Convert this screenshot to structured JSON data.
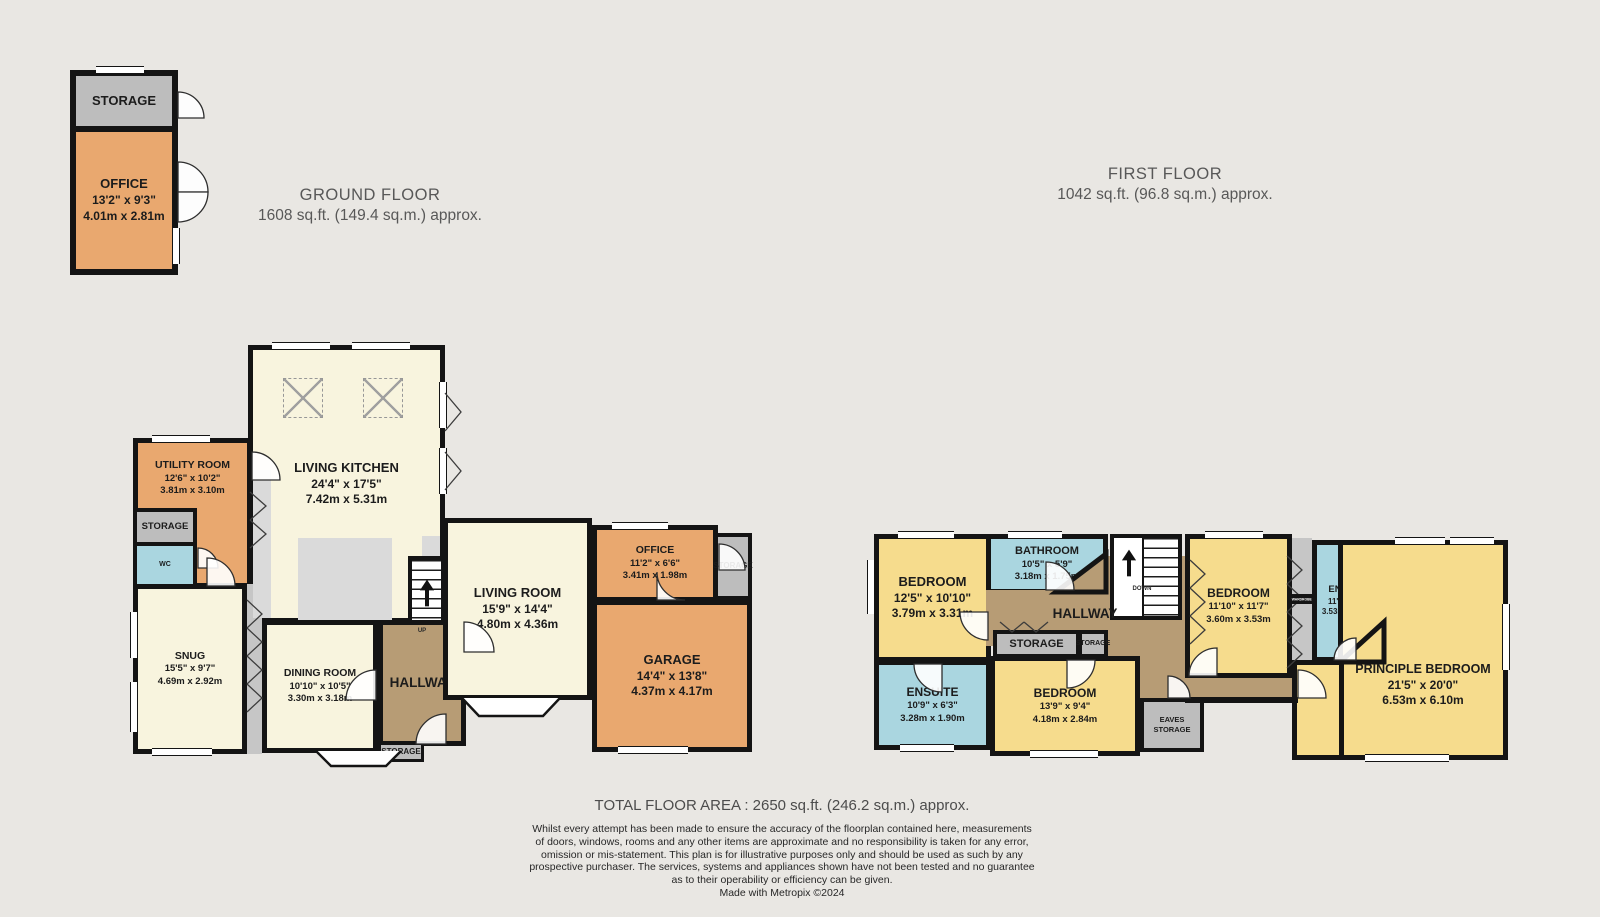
{
  "titles": {
    "ground_floor": {
      "name": "GROUND FLOOR",
      "area": "1608 sq.ft. (149.4 sq.m.) approx."
    },
    "first_floor": {
      "name": "FIRST FLOOR",
      "area": "1042 sq.ft. (96.8 sq.m.) approx."
    }
  },
  "outbuilding": {
    "storage_label": "STORAGE",
    "office": {
      "name": "OFFICE",
      "imperial": "13'2\" x 9'3\"",
      "metric": "4.01m x 2.81m"
    }
  },
  "ground_floor": {
    "living_kitchen": {
      "name": "LIVING KITCHEN",
      "imperial": "24'4\" x 17'5\"",
      "metric": "7.42m x 5.31m"
    },
    "utility_room": {
      "name": "UTILITY ROOM",
      "imperial": "12'6\" x 10'2\"",
      "metric": "3.81m x 3.10m"
    },
    "storage_label": "STORAGE",
    "wc_label": "WC",
    "snug": {
      "name": "SNUG",
      "imperial": "15'5\" x 9'7\"",
      "metric": "4.69m x 2.92m"
    },
    "dining_room": {
      "name": "DINING ROOM",
      "imperial": "10'10\" x 10'5\"",
      "metric": "3.30m x 3.18m"
    },
    "hallway_label": "HALLWAY",
    "hall_storage_label": "STORAGE",
    "up_label": "UP",
    "living_room": {
      "name": "LIVING ROOM",
      "imperial": "15'9\" x 14'4\"",
      "metric": "4.80m x 4.36m"
    },
    "office": {
      "name": "OFFICE",
      "imperial": "11'2\" x 6'6\"",
      "metric": "3.41m x 1.98m"
    },
    "office_storage_label": "STORAGE",
    "garage": {
      "name": "GARAGE",
      "imperial": "14'4\" x 13'8\"",
      "metric": "4.37m x 4.17m"
    }
  },
  "first_floor": {
    "bedroom_1": {
      "name": "BEDROOM",
      "imperial": "12'5\" x 10'10\"",
      "metric": "3.79m x 3.31m"
    },
    "bathroom": {
      "name": "BATHROOM",
      "imperial": "10'5\" x 5'9\"",
      "metric": "3.18m x 1.75m"
    },
    "hallway_label": "HALLWAY",
    "down_label": "DOWN",
    "storage_label": "STORAGE",
    "storage_small_label": "STORAGE",
    "ensuite_1": {
      "name": "ENSUITE",
      "imperial": "10'9\" x 6'3\"",
      "metric": "3.28m x 1.90m"
    },
    "bedroom_2": {
      "name": "BEDROOM",
      "imperial": "13'9\" x 9'4\"",
      "metric": "4.18m x 2.84m"
    },
    "eaves_storage_label": "EAVES STORAGE",
    "bedroom_3": {
      "name": "BEDROOM",
      "imperial": "11'10\" x 11'7\"",
      "metric": "3.60m x 3.53m"
    },
    "wardrobe_label": "WARDROBE",
    "ensuite_2": {
      "name": "ENSUITE",
      "imperial": "11'7\" x 6'9\"",
      "metric": "3.53m x 2.06m"
    },
    "principle_bedroom": {
      "name": "PRINCIPLE BEDROOM",
      "imperial": "21'5\" x 20'0\"",
      "metric": "6.53m x 6.10m"
    }
  },
  "footer": {
    "total_area": "TOTAL FLOOR AREA : 2650 sq.ft. (246.2 sq.m.) approx.",
    "disclaimer_lines": [
      "Whilst every attempt has been made to ensure the accuracy of the floorplan contained here, measurements",
      "of doors, windows, rooms and any other items are approximate and no responsibility is taken for any error,",
      "omission or mis-statement. This plan is for illustrative purposes only and should be used as such by any",
      "prospective purchaser. The services, systems and appliances shown have not been tested and no guarantee",
      "as to their operability or efficiency can be given.",
      "Made with Metropix ©2024"
    ]
  },
  "colors": {
    "background": "#e9e7e3",
    "wall": "#141414",
    "cream_room": "#f8f4de",
    "orange_room": "#e9a86f",
    "yellow_room": "#f6dc8d",
    "blue_room": "#aad6e0",
    "brown_hall": "#b79c75",
    "gray_storage": "#bdbdbd",
    "title_text": "#585858"
  }
}
